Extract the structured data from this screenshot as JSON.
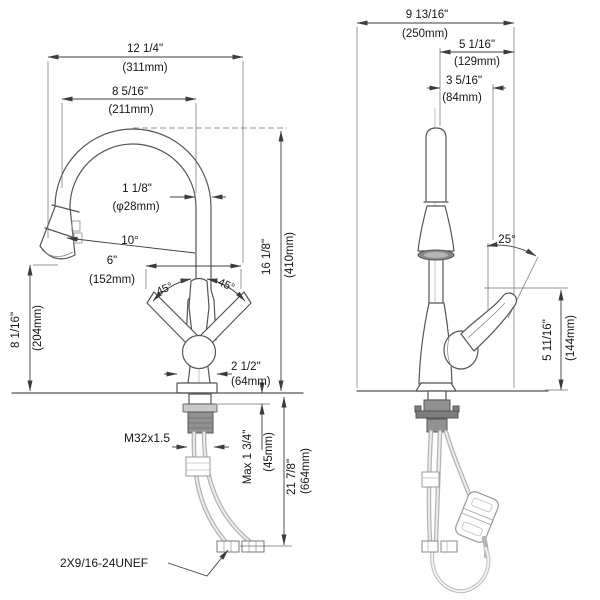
{
  "drawing": {
    "left": {
      "overall_width": {
        "in": "12 1/4\"",
        "mm": "(311mm)"
      },
      "spout_reach": {
        "in": "8 5/16\"",
        "mm": "(211mm)"
      },
      "spout_diameter": {
        "in": "1 1/8\"",
        "mm": "(φ28mm)"
      },
      "spray_angle": "10°",
      "outlet_spread": {
        "in": "6\"",
        "mm": "(152mm)"
      },
      "handle_swing_left": "45°",
      "handle_swing_right": "45°",
      "spout_height": {
        "in": "16 1/8\"",
        "mm": "(410mm)"
      },
      "outlet_clearance": {
        "in": "8 1/16\"",
        "mm": "(204mm)"
      },
      "base_diameter": {
        "in": "2 1/2\"",
        "mm": "(64mm)"
      },
      "shank_thread": "M32x1.5",
      "max_deck_thickness": {
        "in": "Max 1 3/4\"",
        "mm": "(45mm)"
      },
      "hose_length": {
        "in": "21 7/8\"",
        "mm": "(664mm)"
      },
      "supply_connection": "2X9/16-24UNEF"
    },
    "right": {
      "overall_depth": {
        "in": "9 13/16\"",
        "mm": "(250mm)"
      },
      "upper_depth": {
        "in": "5 1/16\"",
        "mm": "(129mm)"
      },
      "spout_offset": {
        "in": "3 5/16\"",
        "mm": "(84mm)"
      },
      "handle_angle": "25°",
      "handle_height": {
        "in": "5 11/16\"",
        "mm": "(144mm)"
      }
    }
  }
}
